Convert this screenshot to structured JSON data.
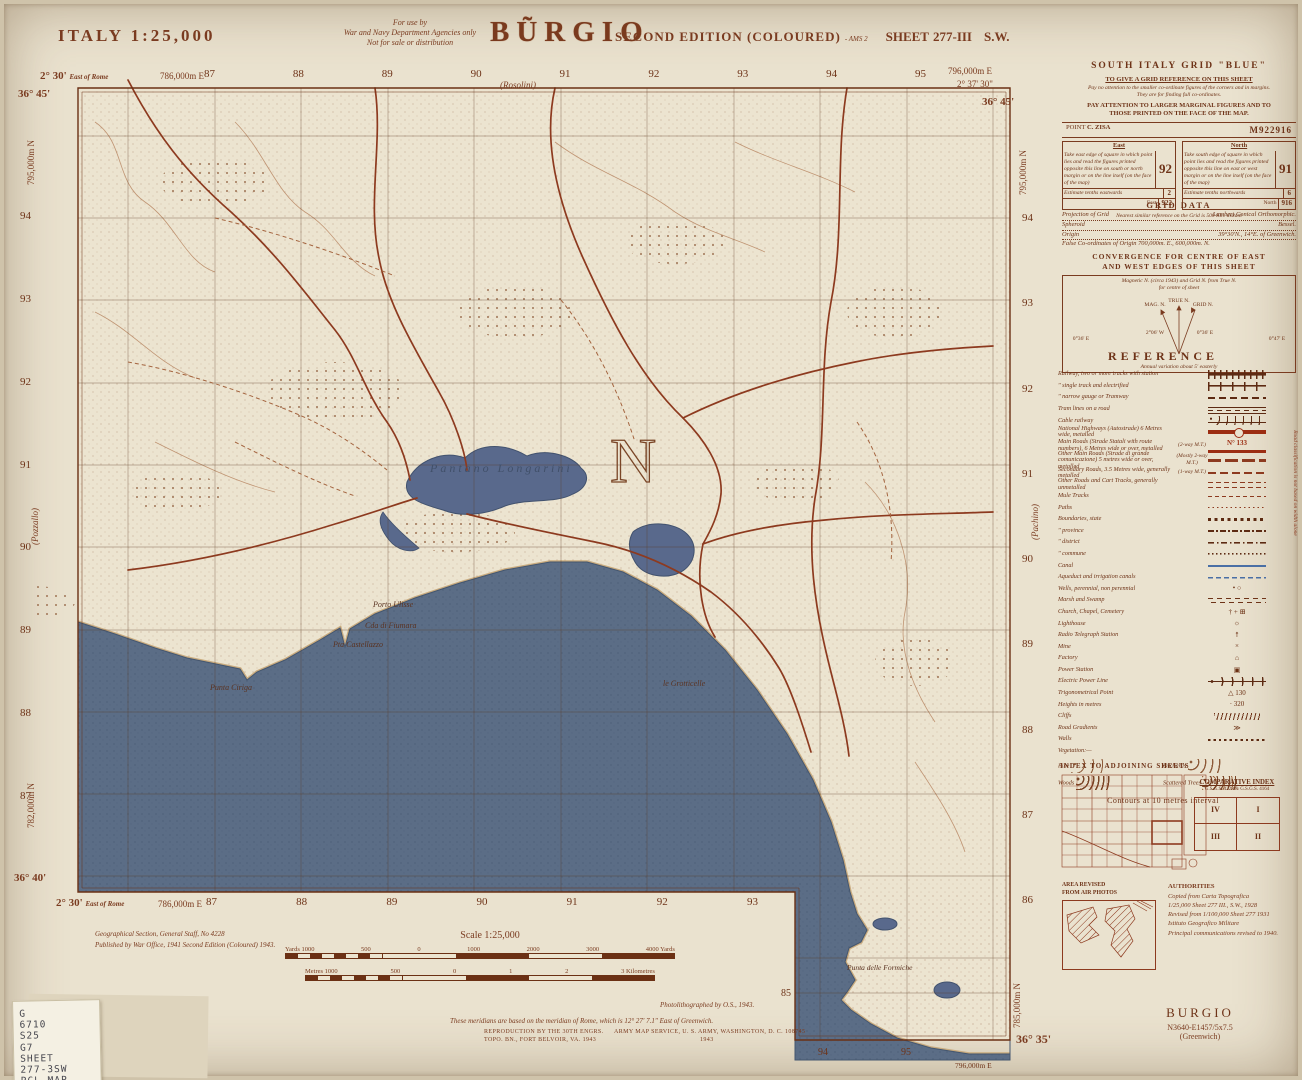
{
  "header": {
    "country_scale": "ITALY   1:25,000",
    "use1": "For use by",
    "use2": "War and Navy Department Agencies only",
    "use3": "Not for sale or distribution",
    "title": "BŨRGIO",
    "edition": "SECOND EDITION (COLOURED)",
    "edition_suffix": "- AMS 2",
    "sheet_word": "SHEET",
    "sheet_no": "277-III",
    "sheet_dir": "S.W."
  },
  "map": {
    "top": {
      "corner_left": "2° 30'",
      "corner_left_note": "East of Rome",
      "easting_left": "786,000m E",
      "numbers": [
        "87",
        "88",
        "89",
        "90",
        "91",
        "92",
        "93",
        "94",
        "95"
      ],
      "place": "(Rosolini)",
      "easting_right": "796,000m E",
      "corner_right": "2° 37' 30\"",
      "lat_left": "36° 45'",
      "lat_right": "36° 45'"
    },
    "left": {
      "northing_top": "795,000m N",
      "numbers": [
        "94",
        "93",
        "92",
        "91",
        "90",
        "89",
        "88",
        "87"
      ],
      "place": "(Pozzallo)",
      "northing_bottom": "782,000m N",
      "lat_bottom": "36° 40'"
    },
    "right": {
      "northing_top": "795,000m N",
      "numbers": [
        "94",
        "93",
        "92",
        "91",
        "90",
        "89",
        "88",
        "87",
        "86"
      ],
      "place": "(Pachino)",
      "northing_bottom": "785,000m N",
      "lat_bottom": "36° 35'"
    },
    "bottom": {
      "corner_left": "2° 30'",
      "corner_left_note": "East of Rome",
      "easting_left": "786,000m E",
      "numbers": [
        "87",
        "88",
        "89",
        "90",
        "91",
        "92",
        "93"
      ],
      "ext_grid": "85",
      "ext_n1": "94",
      "ext_n2": "95",
      "ext_easting": "796,000m E"
    },
    "labels": {
      "lake": "Pantano Longarini",
      "north_letter": "N",
      "porto": "Porto Ulisse",
      "fiumara": "Cda di Fiumara",
      "castellazzo": "Pta Castellazzo",
      "ciriga": "Punta Ciriga",
      "grotticelle": "le Grotticelle",
      "formiche": "Punta delle Formiche"
    }
  },
  "grid_panel": {
    "title": "SOUTH ITALY GRID \"BLUE\"",
    "h1": "TO GIVE A GRID REFERENCE ON THIS SHEET",
    "n1": "Pay no attention to the smaller co-ordinate figures of the corners and in margins.",
    "n2": "They are for finding full co-ordinates.",
    "h2": "PAY ATTENTION TO LARGER MARGINAL FIGURES AND TO",
    "h3": "THOSE PRINTED ON THE FACE OF THE MAP.",
    "point_label": "POINT",
    "point_name": "C. ZISA",
    "point_ref": "M922916",
    "east_head": "East",
    "east_body": "Take east edge of square in which point lies and read the figures printed opposite this line on south or north margin or on the line itself (on the face of the map)",
    "east_big": "92",
    "east_est": "Estimate tenths eastwards",
    "east_est_v": "2",
    "east_foot": "East",
    "east_foot_v": "922",
    "north_head": "North",
    "north_body": "Take south edge of square in which point lies and read the figures printed opposite this line on east or west margin or on the line itself (on the face of the map)",
    "north_big": "91",
    "north_est": "Estimate tenths northwards",
    "north_est_v": "6",
    "north_foot": "North",
    "north_foot_v": "916",
    "footnote": "Nearest similar reference on the Grid is 500 Km. distant"
  },
  "grid_data": {
    "title": "GRID DATA",
    "l1a": "Projection of Grid",
    "l1b": "Lambert Conical Orthomorphic.",
    "l2a": "Spheroid",
    "l2b": "Bessel.",
    "l3a": "Origin",
    "l3b": "39°30'N., 14°E. of Greenwich.",
    "l4": "False Co-ordinates of Origin 700,000m. E., 600,000m. N."
  },
  "convergence": {
    "t1": "CONVERGENCE FOR CENTRE OF EAST",
    "t2": "AND WEST EDGES OF THIS SHEET",
    "cap1": "Magnetic N. (circa 1943) and Grid N. from True N.",
    "cap2": "for centre of sheet",
    "true_n": "TRUE N.",
    "mag_n": "MAG. N.",
    "grid_n": "GRID N.",
    "ang_left": "2°06' W",
    "ang_right": "0°36' E",
    "out_left": "0°36' E",
    "out_right": "0°47' E",
    "foot": "Annual variation about 5' easterly"
  },
  "reference": {
    "title": "REFERENCE",
    "items": [
      {
        "label": "Railway, two or more tracks with station"
      },
      {
        "label": "\"    single track and electrified"
      },
      {
        "label": "\"    narrow gauge or Tramway"
      },
      {
        "label": "Tram lines on a road"
      },
      {
        "label": "Cable railway"
      },
      {
        "label": "National Highways (Autostrade) 6 Metres wide, metalled"
      },
      {
        "label": "Main Roads (Strade Statali with route numbers), 6 Metres wide or over, metalled",
        "note": "(2-way M.T.)",
        "extra": "N° 133"
      },
      {
        "label": "Other Main Roads (Strade di grande comunicazione) 5 metres wide or over, metalled",
        "note": "(Mostly 2-way M.T.)"
      },
      {
        "label": "Secondary Roads, 3.5 Metres wide, generally metalled",
        "note": "(1-way M.T.)"
      },
      {
        "label": "Other Roads and Cart Tracks, generally unmetalled"
      },
      {
        "label": "Mule Tracks"
      },
      {
        "label": "Paths"
      },
      {
        "label": "Boundaries, state"
      },
      {
        "label": "\"    province"
      },
      {
        "label": "\"    district"
      },
      {
        "label": "\"    commune"
      },
      {
        "label": "Canal"
      },
      {
        "label": "Aqueduct and irrigation canals"
      },
      {
        "label": "Wells, perennial, non perennial",
        "glyph": "•   ○"
      },
      {
        "label": "Marsh and Swamp"
      },
      {
        "label": "Church, Chapel, Cemetery",
        "glyph": "† + ⊞"
      },
      {
        "label": "Lighthouse",
        "glyph": "☼"
      },
      {
        "label": "Radio Telegraph Station",
        "glyph": "↟"
      },
      {
        "label": "Mine",
        "glyph": "×"
      },
      {
        "label": "Factory",
        "glyph": "⌂"
      },
      {
        "label": "Power Station",
        "glyph": "▣"
      },
      {
        "label": "Electric Power Line"
      },
      {
        "label": "Trigonometrical Point",
        "glyph": "△ 130"
      },
      {
        "label": "Heights in metres",
        "glyph": "· 320"
      },
      {
        "label": "Cliffs"
      },
      {
        "label": "Road Gradients",
        "glyph": "≫"
      },
      {
        "label": "Walls"
      },
      {
        "label": "Vegetation:—"
      }
    ],
    "veg": {
      "pine": "Pine",
      "orchards": "Orchards",
      "woods": "Woods",
      "scattered": "Scattered Trees"
    },
    "contours": "Contours at 10 metres interval",
    "brace_note": "Road classification is not based on width alone"
  },
  "index_sheets": {
    "title": "INDEX TO ADJOINING SHEETS"
  },
  "comparative": {
    "title": "COMPARATIVE INDEX",
    "subtitle": "G.S.G.S. 4228 & G.S.G.S. 4164",
    "q_tl": "IV",
    "q_tr": "I",
    "q_bl": "III",
    "q_br": "II"
  },
  "air_photos": {
    "line1": "AREA REVISED",
    "line2": "FROM AIR PHOTOS"
  },
  "authorities": {
    "title": "AUTHORITIES",
    "l1": "Copied from Carta Topografica",
    "l2": "1/25,000 Sheet 277 III., S.W., 1928",
    "l3": "Revised from 1/100,000 Sheet 277  1931",
    "l4": "Istituto Geografico Militare",
    "l5": "Principal communications revised to 1940."
  },
  "footer": {
    "gsgs1": "Geographical Section, General Staff, No 4228",
    "gsgs2": "Published by War Office, 1941 Second Edition (Coloured) 1943.",
    "scale_title": "Scale 1:25,000",
    "yards": [
      "Yards 1000",
      "500",
      "0",
      "1000",
      "2000",
      "3000",
      "4000 Yards"
    ],
    "metres": [
      "Metres 1000",
      "500",
      "0",
      "1",
      "2",
      "3 Kilometres"
    ],
    "photo": "Photolithographed by O.S., 1943.",
    "meridian": "These meridians are based on the meridian of Rome, which is 12° 27' 7.1\" East of Greenwich.",
    "repro1": "REPRODUCTION BY THE 30TH ENGRS.",
    "repro2": "TOPO. BN., FORT BELVOIR, VA. 1943",
    "ams1": "ARMY MAP SERVICE, U. S. ARMY, WASHINGTON, D. C. 108745",
    "ams2": "1943"
  },
  "sticker": {
    "l1": "G",
    "l2": "6710",
    "l3": "S25",
    "l4": "G7",
    "l5": "SHEET",
    "l6": "277-3SW",
    "l7": "PCL MAP"
  },
  "bottom_right": {
    "name": "BURGIO",
    "ref": "N3640-E1457/5x7.5",
    "datum": "(Greenwich)"
  },
  "colors": {
    "paper": "#eae2cf",
    "sepia": "#7a3b20",
    "sea": "#5b6d86",
    "road_red": "#8d3a1f"
  }
}
